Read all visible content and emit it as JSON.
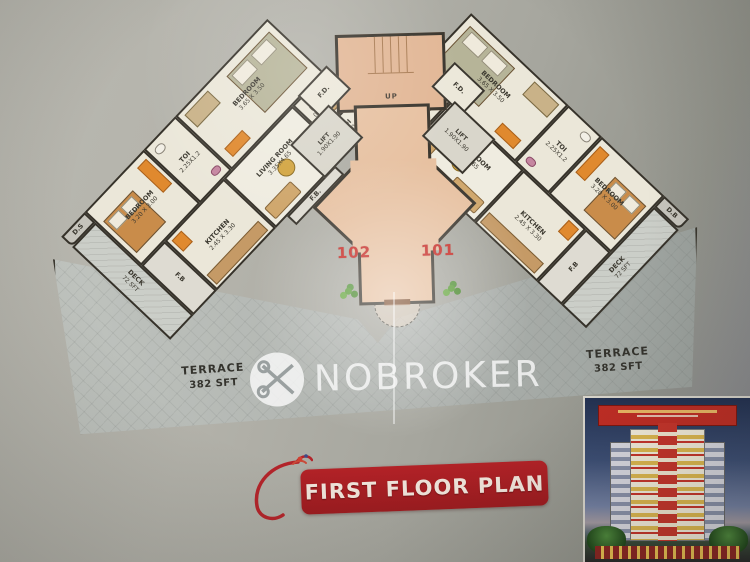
{
  "plan": {
    "flats": [
      {
        "number": "102",
        "duct_label": "D.S",
        "fb_label": "F.B",
        "fb_bottom_label": "F.B.",
        "rooms": {
          "bedroom_top": {
            "name": "BEDROOM",
            "dims": "3.65 X 3.50"
          },
          "toilet_top": {
            "name": "TOI",
            "dims": "2.25X1.2"
          },
          "bedroom_side": {
            "name": "BEDROOM",
            "dims": "3.20 X 3.00"
          },
          "deck": {
            "name": "DECK",
            "dims": "72 SFT"
          },
          "kitchen": {
            "name": "KITCHEN",
            "dims": "2.45 X 3.30"
          },
          "living": {
            "name": "LIVING ROOM",
            "dims": "3.35X4.65"
          },
          "dining": {
            "name": "DINING",
            "dims": "0.65X3.05"
          },
          "toilet_lobby": {
            "name": "TOI",
            "dims": "1.8X0.9"
          }
        }
      },
      {
        "number": "101",
        "duct_label": "D.B",
        "fb_label": "F.B",
        "fb_bottom_label": "F.B.",
        "rooms": {
          "bedroom_top": {
            "name": "BEDROOM",
            "dims": "3.65 X 3.50"
          },
          "toilet_top": {
            "name": "TOI",
            "dims": "2.25X1.2"
          },
          "bedroom_side": {
            "name": "BEDROOM",
            "dims": "3.20 X 3.00"
          },
          "deck": {
            "name": "DECK",
            "dims": "72 SFT"
          },
          "kitchen": {
            "name": "KITCHEN",
            "dims": "2.45 X 3.30"
          },
          "living": {
            "name": "LIVING ROOM",
            "dims": "3.35X4.65"
          },
          "dining": {
            "name": "DINING",
            "dims": "0.65X3.05"
          },
          "toilet_lobby": {
            "name": "TOI",
            "dims": "1.8X0.9"
          }
        }
      }
    ],
    "core": {
      "stair_label": "UP",
      "fd_label": "F.D.",
      "lift_name": "LIFT",
      "lift_dims": "1.90X1.90"
    },
    "terrace": {
      "name": "TERRACE",
      "area": "382 SFT"
    }
  },
  "watermark": {
    "text": "NOBROKER",
    "icon": "nobroker-crossed-keys-logo"
  },
  "footer": {
    "banner_title": "FIRST FLOOR PLAN"
  },
  "colors": {
    "banner_red": "#a91e22",
    "flat_number_red": "#c5251f",
    "lobby_salmon": "#e7c1a1",
    "terrace_gray": "#aeb2ae",
    "wall_line": "#36322a"
  }
}
